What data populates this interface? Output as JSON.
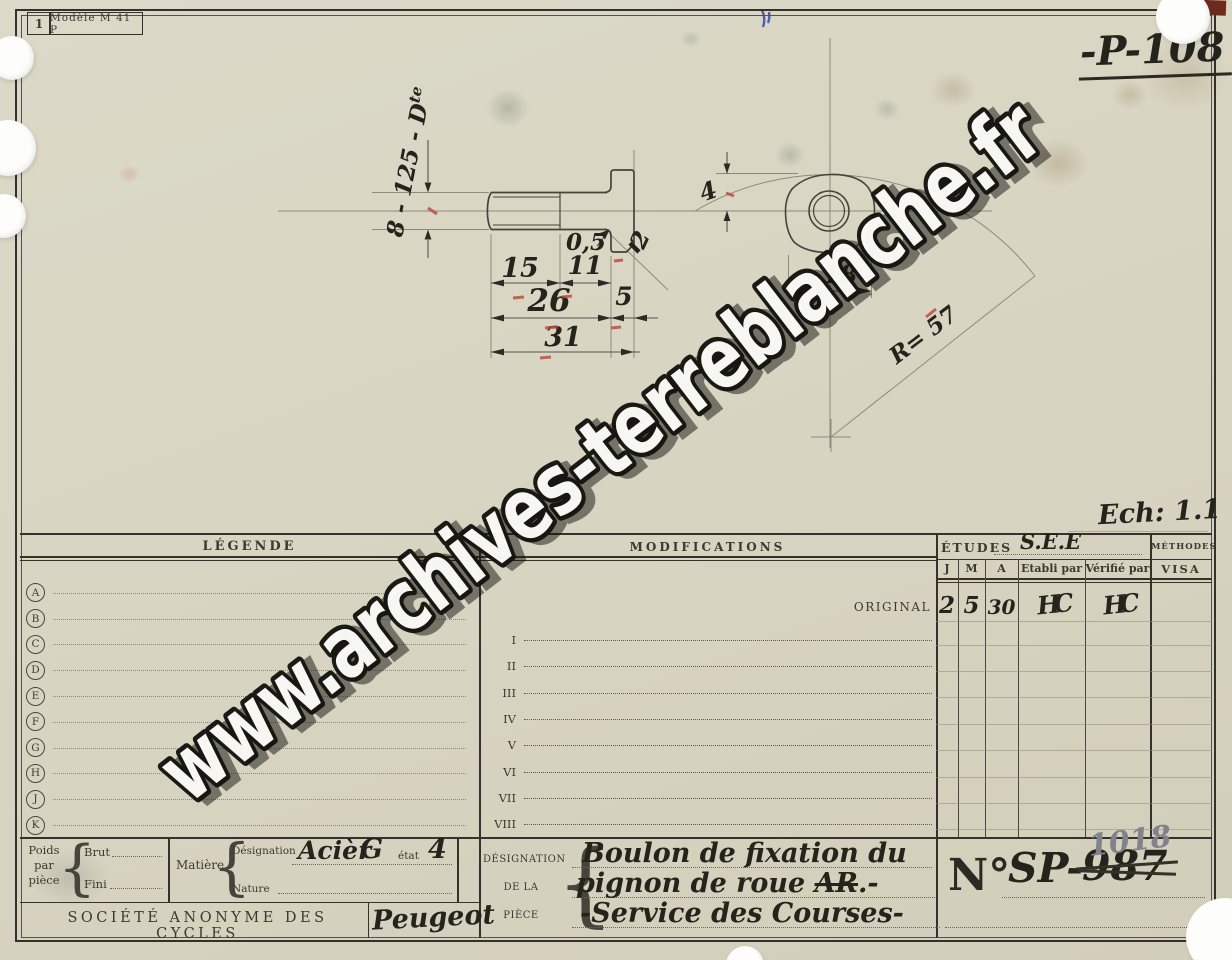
{
  "meta": {
    "sheet_small_number": "1",
    "model_label": "Modèle M 41 P",
    "drawing_number": "-P-108",
    "scale_label": "Ech: 1.1"
  },
  "watermark": {
    "text": "www.archives-terreblanche.fr"
  },
  "drawing": {
    "thread_spec": "8 - 125 - D",
    "thread_spec_sup": "te",
    "dim_15": "15",
    "dim_11": "11",
    "dim_26": "26",
    "dim_5": "5",
    "dim_31": "31",
    "dim_05": "0,5",
    "dim_2": "2",
    "dim_4": "4",
    "dim_18": "18",
    "radius_label": "R= 57"
  },
  "legend": {
    "title": "LÉGENDE",
    "letters": [
      "A",
      "B",
      "C",
      "D",
      "E",
      "F",
      "G",
      "H",
      "J",
      "K"
    ]
  },
  "modifications": {
    "title": "MODIFICATIONS",
    "original_label": "ORIGINAL",
    "rows": [
      "I",
      "II",
      "III",
      "IV",
      "V",
      "VI",
      "VII",
      "VIII"
    ]
  },
  "etudes": {
    "title": "ÉTUDES",
    "service_value": "S.E.E",
    "columns": [
      "J",
      "M",
      "A",
      "Etabli par",
      "Vérifié par"
    ],
    "original_row": {
      "j": "2",
      "m": "5",
      "a": "30",
      "etabli_sig": "HC",
      "verifie_sig": "HC"
    }
  },
  "methodes": {
    "title": "MÉTHODES",
    "visa_label": "VISA"
  },
  "material_block": {
    "poids_lines": [
      "Poids",
      "par",
      "pièce"
    ],
    "brut_label": "Brut",
    "fini_label": "Fini",
    "matiere_label": "Matière",
    "designation_label": "Désignation",
    "designation_value": "Acièr",
    "grade_value": "G",
    "etat_label": "état",
    "etat_value": "4",
    "nature_label": "Nature"
  },
  "company": {
    "name": "SOCIÉTÉ ANONYME DES CYCLES",
    "brand": "Peugeot"
  },
  "piece": {
    "label_lines": [
      "DÉSIGNATION",
      "DE LA",
      "PIÈCE"
    ],
    "line1": "Boulon de fixation du",
    "line2_pre": "pignon de roue ",
    "line2_strike": "AR",
    "line2_post": ".-",
    "line3": "-Service des Courses-"
  },
  "number_block": {
    "prefix": "N°",
    "series": "SP-",
    "old_number": "987",
    "new_number": "1018"
  },
  "misc": {
    "brace": "{"
  }
}
